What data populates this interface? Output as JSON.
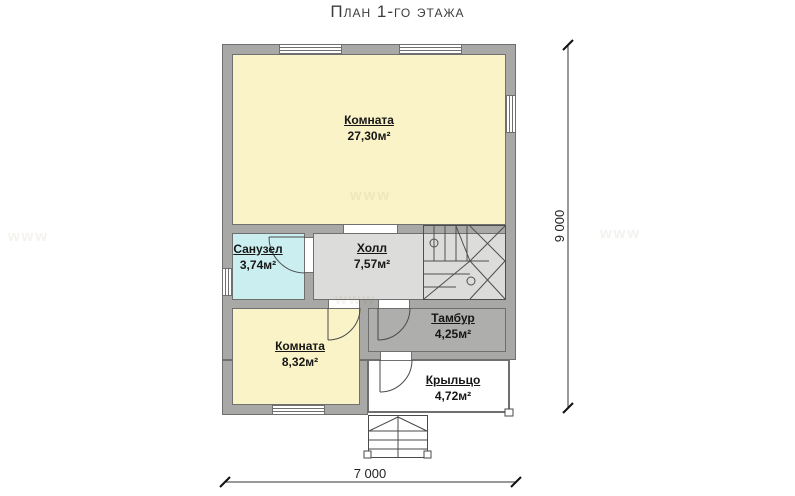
{
  "title": "План 1-го этажа",
  "watermark": "www",
  "rooms": [
    {
      "name": "Комната",
      "area": "27,30м²"
    },
    {
      "name": "Санузел",
      "area": "3,74м²"
    },
    {
      "name": "Холл",
      "area": "7,57м²"
    },
    {
      "name": "Комната",
      "area": "8,32м²"
    },
    {
      "name": "Тамбур",
      "area": "4,25м²"
    },
    {
      "name": "Крыльцо",
      "area": "4,72м²"
    }
  ],
  "dimensions": {
    "overall_width_mm": "7 000",
    "overall_height_mm": "9 000"
  },
  "colors": {
    "wall": "#a8a8a6",
    "outline": "#6f6f6f",
    "room_yellow": "#faf3c8",
    "bathroom_cyan": "#cbeef0",
    "hall_gray": "#dcdcda",
    "tambour_gray": "#aeaeac",
    "porch_white": "#ffffff"
  }
}
